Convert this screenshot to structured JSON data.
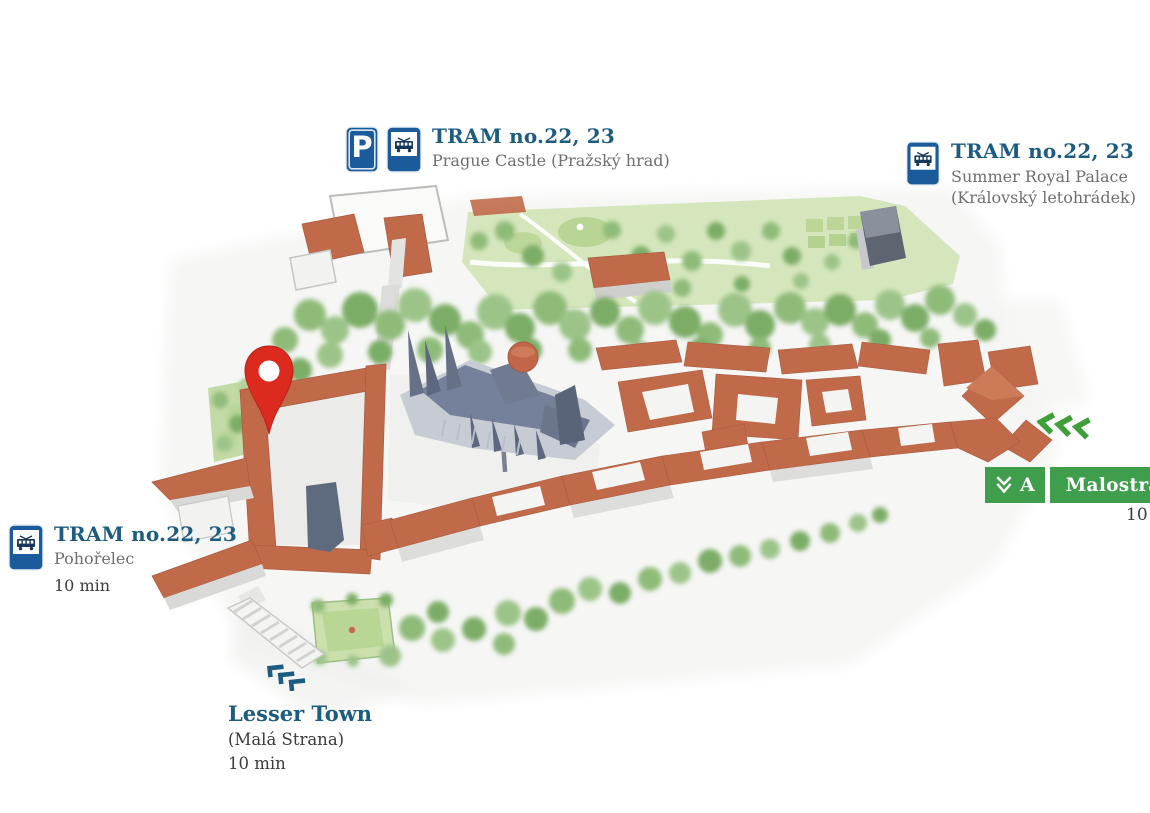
{
  "map_title": "Prague Castle area map",
  "colors": {
    "label_navy": "#1d5c80",
    "subtitle_gray": "#6f6f6f",
    "dark_text": "#3c3c3c",
    "traffic_sign_blue": "#1b5a9b",
    "metro_green": "#3f9e4c",
    "walk_chevron_green": "#3fa03a",
    "pin_red": "#dc2a1f",
    "roof_terracotta": "#c16a4a",
    "tree_green": "#8fbb79",
    "cathedral_slate": "#75809a"
  },
  "signs": {
    "parking_letter": "P"
  },
  "stops": {
    "prague_castle": {
      "title": "TRAM no.22, 23",
      "name": "Prague Castle (Pražský hrad)"
    },
    "summer_palace": {
      "title": "TRAM no.22, 23",
      "name_line1": "Summer Royal Palace",
      "name_line2": "(Královský letohrádek)"
    },
    "pohorelec": {
      "title": "TRAM no.22, 23",
      "name": "Pohořelec",
      "walk_time": "10 min"
    },
    "lesser_town": {
      "title": "Lesser Town",
      "name": "(Malá Strana)",
      "walk_time": "10 min"
    },
    "metro": {
      "line": "A",
      "station": "Malostranská",
      "walk_time": "10 min"
    }
  },
  "icons": {
    "parking-sign": "blue square with white P",
    "tram-stop-sign": "blue sign with white tram pictogram",
    "prague-metro-logo": "white M-arrow on green",
    "location-pin": "red map marker with white hole",
    "walk-direction-chevrons": "three green left chevrons",
    "stairs-chevrons": "three navy step marks"
  }
}
